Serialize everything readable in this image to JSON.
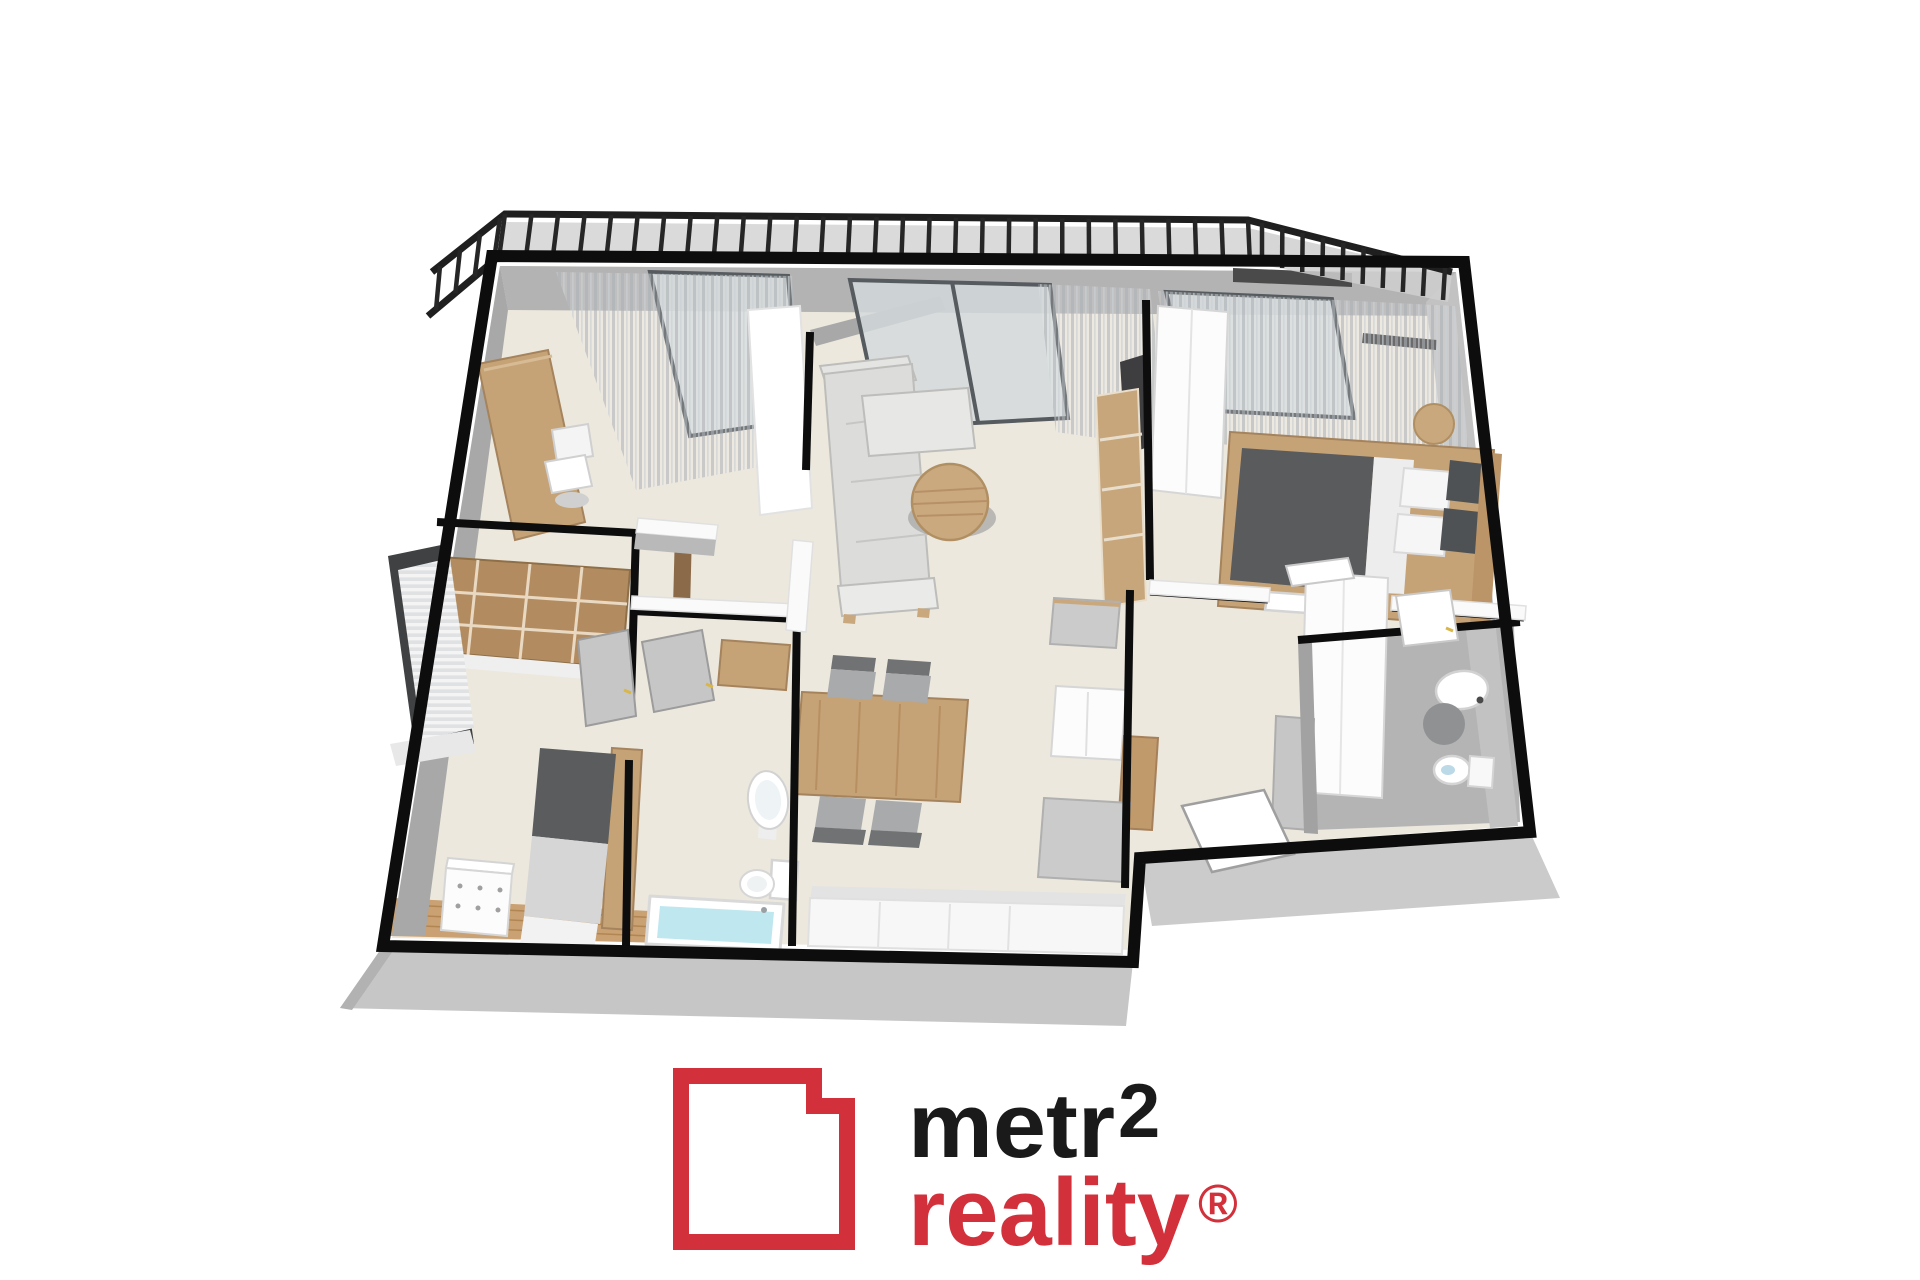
{
  "canvas": {
    "width": 1920,
    "height": 1280,
    "background": "#ffffff"
  },
  "logo": {
    "line1": "metr",
    "superscript": "2",
    "line2": "reality",
    "registered": "®",
    "brand_red": "#d2303a",
    "text_black": "#1a1a1a",
    "icon": "red-square-with-notched-corner"
  },
  "floorplan": {
    "style": "3d-isometric-apartment-render",
    "palette": {
      "outer_wall": "#0d0d0d",
      "floor": "#ece8dd",
      "wall_face_gray": "#b0b0b0",
      "slab_gray": "#c6c6c6",
      "wood": "#c6a377",
      "sofa_gray": "#dcdcda",
      "duvet_dark": "#595b5d",
      "water_blue": "#bfe7f0",
      "glass": "#d3d9dc",
      "bath_floor_gray": "#b4b4b4"
    },
    "rooms": [
      {
        "name": "balcony",
        "features": [
          "railing",
          "deck"
        ]
      },
      {
        "name": "office",
        "features": [
          "desk",
          "office-chair",
          "curtains",
          "window"
        ]
      },
      {
        "name": "living-room",
        "features": [
          "corner-sofa",
          "round-coffee-table",
          "tv",
          "shelf",
          "sliding-glass-door",
          "curtains"
        ]
      },
      {
        "name": "master-bedroom",
        "features": [
          "double-bed",
          "pillows",
          "wood-headboard",
          "round-bedside-table",
          "white-wardrobe",
          "bench",
          "curtains"
        ]
      },
      {
        "name": "second-bedroom",
        "features": [
          "single-bed",
          "white-dresser",
          "walk-in-wardrobe-shelving",
          "window-blinds",
          "wood-floor"
        ]
      },
      {
        "name": "bathroom-main",
        "features": [
          "bathtub",
          "pedestal-sink",
          "toilet",
          "open-door"
        ]
      },
      {
        "name": "bathroom-second",
        "features": [
          "wall-sink",
          "toilet",
          "shower-mat",
          "open-door"
        ]
      },
      {
        "name": "kitchen-dining",
        "features": [
          "dining-table",
          "four-chairs",
          "long-counter",
          "tall-cabinet",
          "wood-island",
          "gray-cabinets"
        ]
      },
      {
        "name": "hallway",
        "features": [
          "entry-door-open",
          "white-closet",
          "gray-cabinet",
          "wood-chest"
        ]
      }
    ]
  }
}
